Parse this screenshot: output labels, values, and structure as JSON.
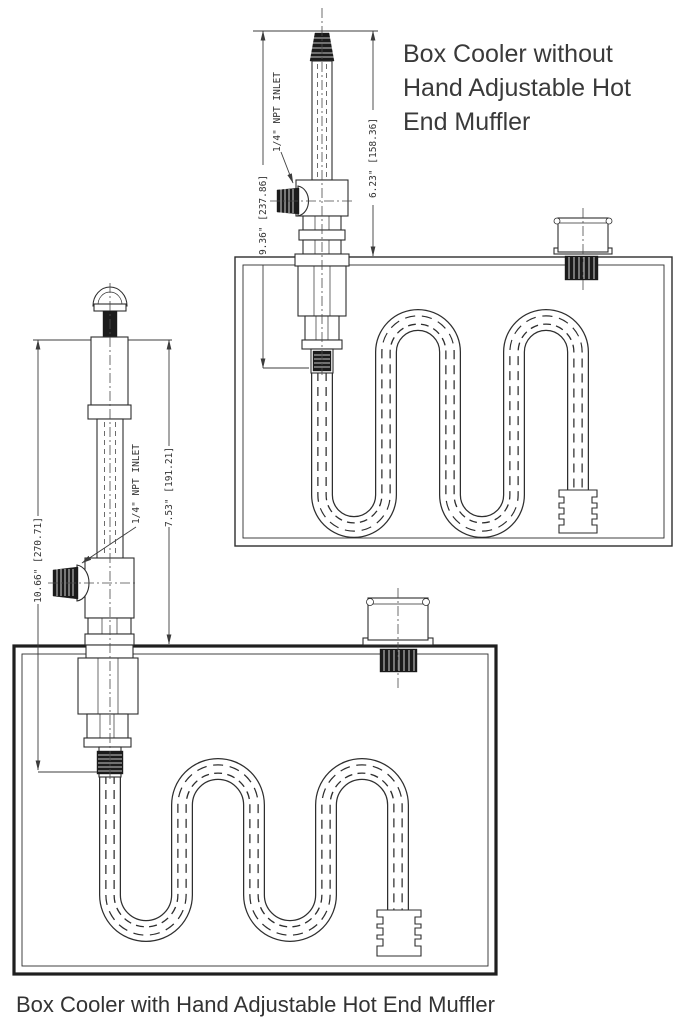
{
  "captions": {
    "without_muffler_lines": [
      "Box Cooler without",
      "Hand Adjustable Hot",
      "End Muffler"
    ],
    "with_muffler": "Box Cooler with Hand Adjustable Hot End Muffler"
  },
  "top_drawing": {
    "title": "Box Cooler without Hand Adjustable Hot End Muffler",
    "dim_overall": "9.36\" [237.86]",
    "dim_upper": "6.23\" [158.36]",
    "inlet_label": "1/4\" NPT INLET"
  },
  "bottom_drawing": {
    "title": "Box Cooler with Hand Adjustable Hot End Muffler",
    "dim_overall": "10.66\" [270.71]",
    "dim_upper": "7.53\" [191.21]",
    "inlet_label": "1/4\" NPT INLET"
  },
  "colors": {
    "background": "#ffffff",
    "line_work": "#2e2e2e",
    "dimension_lines": "#3c3c3c",
    "text": "#3a3a3a"
  }
}
